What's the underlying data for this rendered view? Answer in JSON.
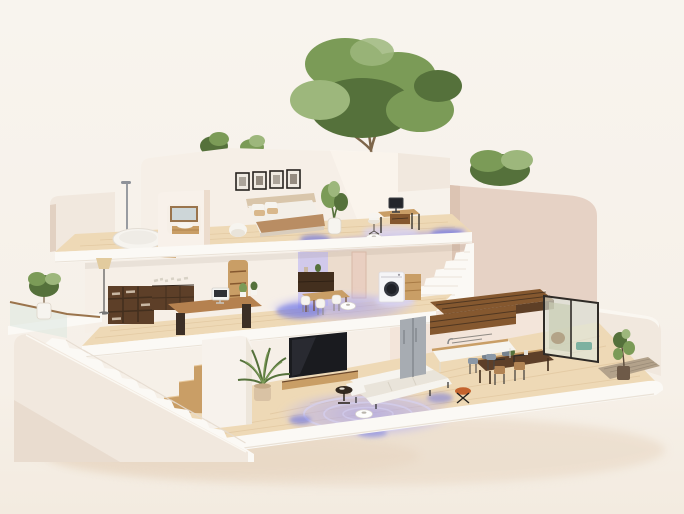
{
  "scene": {
    "type": "3d-render",
    "style": "isometric cutaway dollhouse view",
    "description": "Isometric 3D cutaway render of a modern three-story cream house; robot vacuums with glowing lavender-blue cleaning trails operate on every floor; rooftop trees, external white staircase, balcony and patio.",
    "floors": [
      {
        "name": "top-floor",
        "rooms": [
          "bedroom",
          "bathroom",
          "roof-terrace"
        ],
        "items": [
          "four picture frames",
          "double bed with caramel throw",
          "bedside plant",
          "white armchair",
          "desk with monitor",
          "desk chair",
          "robot vacuum with glowing trail",
          "freestanding bathtub",
          "shower column",
          "wooden stool",
          "mirror",
          "vanity sink",
          "rounded partition wall",
          "staircase down",
          "large tree",
          "two shrubs",
          "small tree"
        ]
      },
      {
        "name": "middle-floor",
        "rooms": [
          "home-office",
          "dining-area",
          "laundry"
        ],
        "items": [
          "dark bookshelf",
          "sideboard with books",
          "floor lamp",
          "writing desk with computer",
          "desk plants",
          "wall niche shelves",
          "lavender-lit wall",
          "dining table",
          "white chairs",
          "dark sideboard",
          "door",
          "washing machine",
          "wooden cabinet",
          "wood slat landing",
          "robot vacuum with glowing trail",
          "balcony with glass railing",
          "potted ficus"
        ]
      },
      {
        "name": "ground-floor",
        "rooms": [
          "living-room",
          "kitchen",
          "dining",
          "patio"
        ],
        "items": [
          "wall TV",
          "media console",
          "rounded partition wall",
          "wooden box stairs",
          "potted palm",
          "white corner sofa",
          "dark side table",
          "orange stool",
          "walnut dining table with chairs",
          "bar stools",
          "kitchen counter",
          "upper wood cabinets",
          "fridge",
          "sliding glass doors",
          "patio chair",
          "teal bench",
          "potted fig on doormat",
          "robot vacuum with spiral glow",
          "external white staircase",
          "sloped parapet wall"
        ]
      }
    ]
  },
  "palette": {
    "background": "#f7f2ec",
    "backgroundWarm": "#f4ece1",
    "groundShadow": "#e6d3bd",
    "creamWall": "#f1e8de",
    "creamWallShade": "#e2d1c2",
    "creamWallDeep": "#d6c0ae",
    "pinkWall": "#e6d2c5",
    "pinkWallShade": "#dcc4b3",
    "interiorWall": "#f6efe7",
    "interiorWallShade": "#ecdccd",
    "slabWhite": "#fbf9f5",
    "slabShade": "#eae2d7",
    "woodFloor": "#eed9b6",
    "woodFloorShade": "#dfc49c",
    "oak": "#c99e66",
    "oakDark": "#a87b45",
    "walnut": "#5d3f28",
    "walnutDark": "#432f1e",
    "slatWood": "#85582f",
    "furnWhite": "#f6f4ef",
    "cushion": "#e9e4da",
    "glowLavender": "#a9a3ec",
    "glowBlue": "#5661e4",
    "glowPale": "#d7d3f7",
    "leaf": "#7b9b57",
    "leafDark": "#55713b",
    "leafLight": "#9db77c",
    "trunk": "#7d654a",
    "tvBlack": "#1a1b1f",
    "metal": "#a7acb2",
    "metalDark": "#7c8187",
    "washerDoor": "#33363e",
    "orange": "#c4632e",
    "teal": "#7cb1a0",
    "glass": "#dde8e0",
    "railWood": "#9a744c",
    "mat": "#b3a28b",
    "potTan": "#d9c2a4",
    "blush": "#e9cfc1",
    "lavWall": "#cdc5f0"
  }
}
